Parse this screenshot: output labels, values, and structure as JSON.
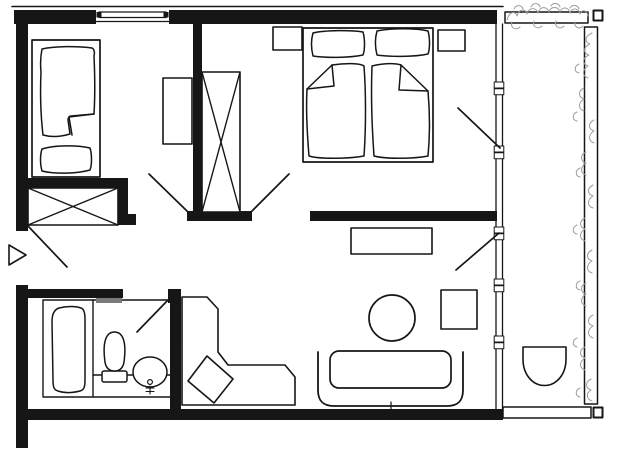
{
  "canvas": {
    "width": 621,
    "height": 460,
    "background": "#ffffff",
    "ink": "#161616",
    "plant_color": "#9c9c9c",
    "shelf_color": "#7a7a7a"
  },
  "elements": [
    {
      "name": "top-facade-line",
      "type": "line",
      "x1": 12,
      "y1": 6.5,
      "x2": 503,
      "y2": 6.5,
      "stroke": "ink",
      "sw": 1.6
    },
    {
      "name": "top-wall-left",
      "type": "rect",
      "x": 14,
      "y": 10,
      "w": 82,
      "h": 14,
      "fill": "ink"
    },
    {
      "name": "top-wall-right",
      "type": "rect",
      "x": 169,
      "y": 10,
      "w": 328,
      "h": 14,
      "fill": "ink"
    },
    {
      "name": "left-wall-upper",
      "type": "rect",
      "x": 16,
      "y": 10,
      "w": 12,
      "h": 221,
      "fill": "ink"
    },
    {
      "name": "left-wall-lower",
      "type": "rect",
      "x": 16,
      "y": 285,
      "w": 12,
      "h": 163,
      "fill": "ink"
    },
    {
      "name": "bottom-wall",
      "type": "rect",
      "x": 16,
      "y": 409,
      "w": 487,
      "h": 11,
      "fill": "ink"
    },
    {
      "name": "center-partition-wall",
      "type": "rect",
      "x": 193,
      "y": 24,
      "w": 9,
      "h": 189,
      "fill": "ink"
    },
    {
      "name": "hall-door-wall",
      "type": "rect",
      "x": 187,
      "y": 211,
      "w": 65,
      "h": 10,
      "fill": "ink"
    },
    {
      "name": "bedroom-living-wall",
      "type": "rect",
      "x": 310,
      "y": 211,
      "w": 187,
      "h": 10,
      "fill": "ink"
    },
    {
      "name": "closet-top-wall",
      "type": "rect",
      "x": 26,
      "y": 178,
      "w": 98,
      "h": 11,
      "fill": "ink"
    },
    {
      "name": "closet-right-wall",
      "type": "rect",
      "x": 115,
      "y": 178,
      "w": 13,
      "h": 47,
      "fill": "ink"
    },
    {
      "name": "closet-wall-notch",
      "type": "rect",
      "x": 128,
      "y": 214,
      "w": 8,
      "h": 11,
      "fill": "ink"
    },
    {
      "name": "bathroom-top-wall",
      "type": "rect",
      "x": 28,
      "y": 289,
      "w": 95,
      "h": 9,
      "fill": "ink"
    },
    {
      "name": "bathroom-door-stub",
      "type": "rect",
      "x": 168,
      "y": 289,
      "w": 13,
      "h": 14,
      "fill": "ink"
    },
    {
      "name": "bathroom-side-wall",
      "type": "rect",
      "x": 170,
      "y": 298,
      "w": 11,
      "h": 121,
      "fill": "ink"
    },
    {
      "name": "window-glazing-bar",
      "type": "rect",
      "x": 99,
      "y": 12,
      "w": 67,
      "h": 5.5,
      "fill": "white",
      "stroke": "ink",
      "sw": 1.2
    },
    {
      "name": "window-end-block-left",
      "type": "rect",
      "x": 96.5,
      "y": 12,
      "w": 5,
      "h": 5.5,
      "fill": "ink"
    },
    {
      "name": "window-end-block-right",
      "type": "rect",
      "x": 163.5,
      "y": 12,
      "w": 5,
      "h": 5.5,
      "fill": "ink"
    },
    {
      "name": "window-inner-sill-line",
      "type": "line",
      "x1": 96,
      "y1": 21.5,
      "x2": 169,
      "y2": 21.5,
      "stroke": "ink",
      "sw": 1.2
    },
    {
      "name": "glazing-outer-line",
      "type": "line",
      "x1": 496,
      "y1": 24,
      "x2": 496,
      "y2": 409,
      "stroke": "ink",
      "sw": 1.3
    },
    {
      "name": "glazing-inner-line",
      "type": "line",
      "x1": 502.5,
      "y1": 24,
      "x2": 502.5,
      "y2": 409,
      "stroke": "ink",
      "sw": 1.3
    },
    {
      "name": "glazing-mullion",
      "type": "rect",
      "x": 494.2,
      "y": 82,
      "w": 9.6,
      "h": 6,
      "fill": "white",
      "stroke": "ink",
      "sw": 1
    },
    {
      "name": "glazing-mullion",
      "type": "rect",
      "x": 494.2,
      "y": 88.8,
      "w": 9.6,
      "h": 6,
      "fill": "white",
      "stroke": "ink",
      "sw": 1
    },
    {
      "name": "glazing-mullion",
      "type": "rect",
      "x": 494.2,
      "y": 146,
      "w": 9.6,
      "h": 6,
      "fill": "white",
      "stroke": "ink",
      "sw": 1
    },
    {
      "name": "glazing-mullion",
      "type": "rect",
      "x": 494.2,
      "y": 152.8,
      "w": 9.6,
      "h": 6,
      "fill": "white",
      "stroke": "ink",
      "sw": 1
    },
    {
      "name": "glazing-mullion",
      "type": "rect",
      "x": 494.2,
      "y": 227,
      "w": 9.6,
      "h": 6,
      "fill": "white",
      "stroke": "ink",
      "sw": 1
    },
    {
      "name": "glazing-mullion",
      "type": "rect",
      "x": 494.2,
      "y": 233.8,
      "w": 9.6,
      "h": 6,
      "fill": "white",
      "stroke": "ink",
      "sw": 1
    },
    {
      "name": "glazing-mullion",
      "type": "rect",
      "x": 494.2,
      "y": 279,
      "w": 9.6,
      "h": 6,
      "fill": "white",
      "stroke": "ink",
      "sw": 1
    },
    {
      "name": "glazing-mullion",
      "type": "rect",
      "x": 494.2,
      "y": 285.8,
      "w": 9.6,
      "h": 6,
      "fill": "white",
      "stroke": "ink",
      "sw": 1
    },
    {
      "name": "glazing-mullion",
      "type": "rect",
      "x": 494.2,
      "y": 336,
      "w": 9.6,
      "h": 6,
      "fill": "white",
      "stroke": "ink",
      "sw": 1
    },
    {
      "name": "glazing-mullion",
      "type": "rect",
      "x": 494.2,
      "y": 342.8,
      "w": 9.6,
      "h": 6,
      "fill": "white",
      "stroke": "ink",
      "sw": 1
    },
    {
      "name": "balcony-top-rail",
      "type": "rect",
      "x": 505,
      "y": 12,
      "w": 83,
      "h": 11,
      "fill": "white",
      "stroke": "ink",
      "sw": 1.5
    },
    {
      "name": "balcony-top-post",
      "type": "rect",
      "x": 593.5,
      "y": 10.5,
      "w": 9,
      "h": 10,
      "fill": "white",
      "stroke": "ink",
      "sw": 2
    },
    {
      "name": "balcony-side-rail",
      "type": "rect",
      "x": 584.5,
      "y": 27,
      "w": 13,
      "h": 377,
      "fill": "white",
      "stroke": "ink",
      "sw": 1.5
    },
    {
      "name": "balcony-bottom-rail",
      "type": "rect",
      "x": 503,
      "y": 407,
      "w": 88,
      "h": 11,
      "fill": "white",
      "stroke": "ink",
      "sw": 1.5
    },
    {
      "name": "balcony-bottom-post",
      "type": "rect",
      "x": 593.5,
      "y": 407.5,
      "w": 9,
      "h": 10,
      "fill": "white",
      "stroke": "ink",
      "sw": 2
    },
    {
      "name": "balcony-chair",
      "type": "path",
      "d": "M523,347 L566,347 L566,359 C566,374.5 556.5,385.5 544.5,385.5 C532.5,385.5 523,374.5 523,359 Z",
      "fill": "white",
      "stroke": "ink",
      "sw": 1.6
    },
    {
      "name": "plants-top",
      "type": "path",
      "d": "M507,20 C509,12 515,10 517,16 C519,9 525,8 527,14 C529,7 536,7 538,13 C540,6 547,6 549,12 C551,6 558,6 560,12 C562,6 569,7 570,13 C572,7 579,8 580,14 C582,9 587,10 588,16 M512,22 C510,28 516,31 520,27 M534,21 C532,27 538,30 542,26 M556,21 C554,27 560,30 564,26 M575,22 C574,27 579,30 583,26",
      "fill": "none",
      "stroke": "plant",
      "sw": 1
    },
    {
      "name": "plants-top-2",
      "type": "path",
      "d": "M514,9 C516,4 522,5 523,9 M531,7 C533,2 539,3 540,7 M551,6 C553,2 559,3 560,7 M570,8 C572,4 578,5 579,9",
      "fill": "none",
      "stroke": "plant",
      "sw": 1
    },
    {
      "name": "plants-right",
      "type": "path",
      "d": "M592,33 C585,36 584,42 590,44 C583,47 583,53 589,55 C582,58 582,64 588,66 C582,70 582,76 588,78 M584,88 C578,91 578,97 584,99 C578,103 578,109 584,111 M594,120 C588,123 588,129 594,131 C588,135 588,141 594,143 M586,152 C580,155 580,161 586,163 C580,167 580,173 586,175 M593,185 C587,188 587,194 593,196 C587,200 587,206 593,208 M585,218 C579,221 579,227 585,229 C579,233 579,239 585,241 M592,250 C586,253 586,259 592,261 C586,265 586,271 592,273 M586,283 C580,286 580,292 586,294 C580,298 580,304 586,306 M593,315 C587,318 587,324 593,326 C587,330 587,336 593,338 M585,347 C579,350 579,356 585,358 C579,362 579,368 585,370 M591,379 C585,382 585,388 591,390 C586,393 586,399 592,401",
      "fill": "none",
      "stroke": "plant",
      "sw": 1
    },
    {
      "name": "plants-right-2",
      "type": "path",
      "d": "M579,64 C574,66 574,72 579,73 M577,112 C572,114 572,120 577,121 M580,168 C575,170 575,176 580,177 M577,225 C572,227 572,233 577,234 M580,281 C575,283 575,289 580,290 M577,338 C572,340 572,346 577,347 M580,388 C575,390 575,396 580,397",
      "fill": "none",
      "stroke": "plant",
      "sw": 1
    },
    {
      "name": "single-bed-frame",
      "type": "rect",
      "x": 32,
      "y": 40,
      "w": 68,
      "h": 137,
      "fill": "white",
      "stroke": "ink",
      "sw": 1.7
    },
    {
      "name": "single-bed-blanket",
      "type": "path",
      "d": "M42,49 C55,46 78,46 92,48 C94,49 95,52 94,56 C95,78 95,98 94,114 L71,116 C69,116 68,118 68,120 L70,134 C60,137 50,137 43,135 C41,118 40,95 41,72 C40,62 41,54 42,49 Z",
      "fill": "white",
      "stroke": "ink",
      "sw": 1.5
    },
    {
      "name": "single-bed-blanket-fold",
      "type": "path",
      "d": "M94,114 L69,117 L72,135",
      "fill": "none",
      "stroke": "ink",
      "sw": 1.5
    },
    {
      "name": "single-bed-pillow",
      "type": "path",
      "d": "M42,149 C54,145 78,145 90,148 C92,154 92,165 90,170 C76,174 54,174 42,171 C40,164 40,155 42,149 Z",
      "fill": "white",
      "stroke": "ink",
      "sw": 1.5
    },
    {
      "name": "left-room-shelf",
      "type": "rect",
      "x": 163,
      "y": 78,
      "w": 29,
      "h": 66,
      "fill": "white",
      "stroke": "ink",
      "sw": 1.6
    },
    {
      "name": "closet-left-box",
      "type": "rect",
      "x": 28,
      "y": 188,
      "w": 90,
      "h": 37,
      "fill": "white",
      "stroke": "ink",
      "sw": 1.6
    },
    {
      "name": "closet-left-x",
      "type": "line",
      "x1": 28,
      "y1": 188,
      "x2": 118,
      "y2": 225,
      "stroke": "ink",
      "sw": 1.4
    },
    {
      "name": "closet-left-x",
      "type": "line",
      "x1": 118,
      "y1": 188,
      "x2": 28,
      "y2": 225,
      "stroke": "ink",
      "sw": 1.4
    },
    {
      "name": "closet-tall-box",
      "type": "rect",
      "x": 202,
      "y": 72,
      "w": 38,
      "h": 140,
      "fill": "white",
      "stroke": "ink",
      "sw": 1.6
    },
    {
      "name": "closet-tall-x",
      "type": "line",
      "x1": 202,
      "y1": 72,
      "x2": 240,
      "y2": 212,
      "stroke": "ink",
      "sw": 1.4
    },
    {
      "name": "closet-tall-x",
      "type": "line",
      "x1": 240,
      "y1": 72,
      "x2": 202,
      "y2": 212,
      "stroke": "ink",
      "sw": 1.4
    },
    {
      "name": "double-bed-frame",
      "type": "rect",
      "x": 303,
      "y": 28,
      "w": 130,
      "h": 134,
      "fill": "white",
      "stroke": "ink",
      "sw": 1.7
    },
    {
      "name": "double-bed-pillow-left",
      "type": "path",
      "d": "M313,33 C325,30 352,30 363,32 C365,39 365,50 363,55 C348,58 326,58 313,56 C311,48 311,40 313,33 Z",
      "fill": "white",
      "stroke": "ink",
      "sw": 1.5
    },
    {
      "name": "double-bed-pillow-right",
      "type": "path",
      "d": "M377,31 C390,28 416,28 428,31 C430,38 430,49 428,54 C414,57 390,57 377,55 C375,47 375,38 377,31 Z",
      "fill": "white",
      "stroke": "ink",
      "sw": 1.5
    },
    {
      "name": "double-bed-blanket-left",
      "type": "path",
      "d": "M332,65 C345,63 360,63 364,66 C366,92 366,128 364,156 C348,159 318,159 309,156 C307,132 306,108 307,89 Z",
      "fill": "white",
      "stroke": "ink",
      "sw": 1.5
    },
    {
      "name": "double-bed-blanket-left-fold",
      "type": "path",
      "d": "M307,89 L334,86 L332,65",
      "fill": "none",
      "stroke": "ink",
      "sw": 1.5
    },
    {
      "name": "double-bed-blanket-right",
      "type": "path",
      "d": "M372,66 C383,63 396,63 401,65 L428,91 C430,114 430,135 428,156 C413,159 385,159 374,156 C372,128 371,92 372,66 Z",
      "fill": "white",
      "stroke": "ink",
      "sw": 1.5
    },
    {
      "name": "double-bed-blanket-right-fold",
      "type": "path",
      "d": "M401,65 L399,90 L428,91",
      "fill": "none",
      "stroke": "ink",
      "sw": 1.5
    },
    {
      "name": "nightstand-left",
      "type": "rect",
      "x": 273,
      "y": 27,
      "w": 29,
      "h": 23,
      "fill": "white",
      "stroke": "ink",
      "sw": 1.6
    },
    {
      "name": "nightstand-right",
      "type": "rect",
      "x": 438,
      "y": 30,
      "w": 27,
      "h": 21,
      "fill": "white",
      "stroke": "ink",
      "sw": 1.6
    },
    {
      "name": "sideboard",
      "type": "rect",
      "x": 351,
      "y": 228,
      "w": 81,
      "h": 26,
      "fill": "white",
      "stroke": "ink",
      "sw": 1.6
    },
    {
      "name": "round-table",
      "type": "circle",
      "cx": 392,
      "cy": 318,
      "r": 23,
      "fill": "white",
      "stroke": "ink",
      "sw": 1.7
    },
    {
      "name": "square-chair",
      "type": "rect",
      "x": 441,
      "y": 290,
      "w": 36,
      "h": 39,
      "fill": "white",
      "stroke": "ink",
      "sw": 1.6
    },
    {
      "name": "sofa-back",
      "type": "path",
      "d": "M318,352 L318,390 C318,401 323,406 334,406 L447,406 C458,406 463,401 463,390 L463,352",
      "fill": "none",
      "stroke": "ink",
      "sw": 1.8
    },
    {
      "name": "sofa-seat",
      "type": "rect",
      "x": 330,
      "y": 351,
      "w": 121,
      "h": 37,
      "rx": 9,
      "fill": "white",
      "stroke": "ink",
      "sw": 1.7
    },
    {
      "name": "sofa-center-mark",
      "type": "line",
      "x1": 391,
      "y1": 402,
      "x2": 391,
      "y2": 409,
      "stroke": "ink",
      "sw": 1.2
    },
    {
      "name": "corner-bench",
      "type": "path",
      "d": "M182,297 L207,297 L218,309 L218,352 L228,365 L285,365 L295,377 L295,405 L182,405 Z",
      "fill": "white",
      "stroke": "ink",
      "sw": 1.6
    },
    {
      "name": "bench-diamond-table",
      "type": "polygon",
      "points": "207,356 233,379 214,403 188,381",
      "fill": "white",
      "stroke": "ink",
      "sw": 1.6
    },
    {
      "name": "bathroom-outline",
      "type": "rect",
      "x": 43,
      "y": 300,
      "w": 128,
      "h": 97,
      "fill": "none",
      "stroke": "ink",
      "sw": 1.4
    },
    {
      "name": "tub-divider",
      "type": "line",
      "x1": 93,
      "y1": 300,
      "x2": 93,
      "y2": 397,
      "stroke": "ink",
      "sw": 1.4
    },
    {
      "name": "bathtub",
      "type": "path",
      "d": "M59,308 C67,306 76,306 81,308 C84,309 85,313 85,319 L85,380 C85,387 84,390 80,391 C72,393 64,393 58,391 C54,390 53,387 53,380 L52,322 C52,314 54,310 59,308 Z",
      "fill": "white",
      "stroke": "ink",
      "sw": 1.5
    },
    {
      "name": "vanity-counter-line",
      "type": "line",
      "x1": 93,
      "y1": 375,
      "x2": 171,
      "y2": 375,
      "stroke": "ink",
      "sw": 1.4
    },
    {
      "name": "toilet-tank",
      "type": "rect",
      "x": 102,
      "y": 371,
      "w": 25,
      "h": 11,
      "rx": 2,
      "fill": "white",
      "stroke": "ink",
      "sw": 1.5
    },
    {
      "name": "toilet-bowl",
      "type": "path",
      "d": "M105,362 C102,340 107,332 114.5,332 C122,332 127,340 124,362 C123,368 120,371 114.5,371 C109,371 106,368 105,362 Z",
      "fill": "white",
      "stroke": "ink",
      "sw": 1.5
    },
    {
      "name": "washbasin",
      "type": "ellipse",
      "cx": 150,
      "cy": 372,
      "rx": 17,
      "ry": 15,
      "fill": "white",
      "stroke": "ink",
      "sw": 1.5
    },
    {
      "name": "washbasin-drain",
      "type": "circle",
      "cx": 150,
      "cy": 382,
      "r": 2.4,
      "fill": "white",
      "stroke": "ink",
      "sw": 1.2
    },
    {
      "name": "washbasin-faucet",
      "type": "path",
      "d": "M150,386 L150,394 M146,388 L154,388 M146,391.5 L154,391.5",
      "fill": "none",
      "stroke": "ink",
      "sw": 1.1
    },
    {
      "name": "bathroom-shelf",
      "type": "rect",
      "x": 96,
      "y": 298,
      "w": 26,
      "h": 5,
      "fill": "shelf"
    },
    {
      "name": "entry-door-leaf",
      "type": "line",
      "x1": 28,
      "y1": 226,
      "x2": 67,
      "y2": 267,
      "stroke": "ink",
      "sw": 1.7
    },
    {
      "name": "entry-arrow",
      "type": "polygon",
      "points": "9,245 9,265 26,255",
      "fill": "white",
      "stroke": "ink",
      "sw": 1.6
    },
    {
      "name": "left-room-door-leaf",
      "type": "line",
      "x1": 188,
      "y1": 212,
      "x2": 149,
      "y2": 174,
      "stroke": "ink",
      "sw": 1.7
    },
    {
      "name": "bedroom-door-leaf",
      "type": "line",
      "x1": 251,
      "y1": 212,
      "x2": 289,
      "y2": 174,
      "stroke": "ink",
      "sw": 1.7
    },
    {
      "name": "bedroom-balcony-door-leaf",
      "type": "line",
      "x1": 500,
      "y1": 148,
      "x2": 458,
      "y2": 108,
      "stroke": "ink",
      "sw": 1.7
    },
    {
      "name": "living-balcony-door-leaf",
      "type": "line",
      "x1": 499,
      "y1": 233,
      "x2": 456,
      "y2": 270,
      "stroke": "ink",
      "sw": 1.7
    },
    {
      "name": "bathroom-door-leaf",
      "type": "line",
      "x1": 168,
      "y1": 300,
      "x2": 137,
      "y2": 332,
      "stroke": "ink",
      "sw": 1.7
    }
  ]
}
